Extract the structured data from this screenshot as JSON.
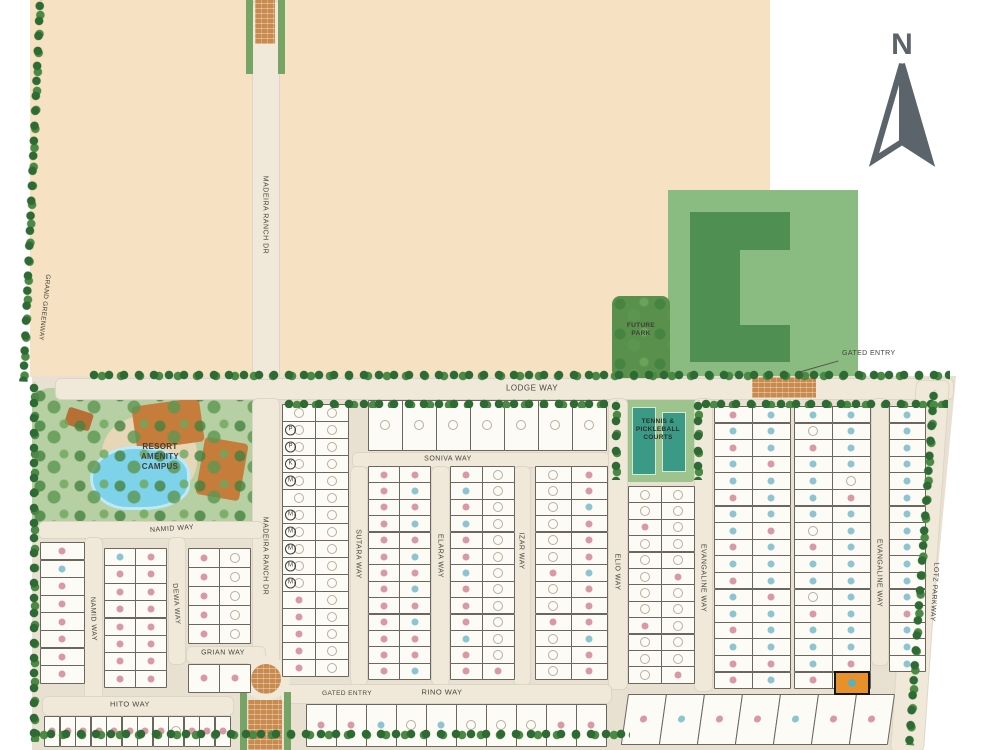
{
  "map": {
    "compass_label": "N",
    "labels": {
      "gated_entry_top": "GATED ENTRY",
      "gated_entry_bottom": "GATED ENTRY"
    },
    "areas": [
      {
        "id": "grand-greenway",
        "label": "GRAND GREENWAY"
      },
      {
        "id": "resort-amenity-campus",
        "label": "RESORT\nAMENITY\nCAMPUS"
      },
      {
        "id": "future-park",
        "label": "FUTURE\nPARK"
      },
      {
        "id": "tennis-pickleball-courts",
        "label": "TENNIS &\nPICKLEBALL\nCOURTS"
      },
      {
        "id": "future-site"
      }
    ],
    "colors": {
      "undeveloped": "#f6e2c2",
      "ground": "#e8e0d0",
      "road": "#f0e9da",
      "lot": "#fdfbf5",
      "greenway": "#5c8f4e",
      "park_light": "#8abc81",
      "park_dark": "#4f8f52",
      "court": "#3a9a85",
      "brick": "#c98a4e",
      "pool": "#7ed3ea",
      "building": "#c67c3b",
      "dot_pink": "#d998a5",
      "dot_blue": "#8ec4d2",
      "dot_open": "#b7af9f",
      "selected": "#e8912b"
    },
    "streets": [
      {
        "id": "lodge-way",
        "label": "LODGE WAY",
        "x": 55,
        "y": 378,
        "w": 897,
        "h": 20,
        "lx": 532,
        "ly": 388,
        "rot": 0,
        "fs": 8
      },
      {
        "id": "madeira-ranch-dr-north",
        "label": "MADEIRA RANCH DR",
        "x": 252,
        "y": 0,
        "w": 26,
        "h": 378,
        "lx": 265,
        "ly": 215,
        "rot": 90,
        "fs": 7
      },
      {
        "id": "madeira-ranch-dr-south",
        "label": "MADEIRA RANCH DR",
        "x": 252,
        "y": 398,
        "w": 26,
        "h": 288,
        "lx": 265,
        "ly": 556,
        "rot": 90,
        "fs": 7
      },
      {
        "id": "soniva-way",
        "label": "SONIVA WAY",
        "x": 352,
        "y": 452,
        "w": 256,
        "h": 14,
        "lx": 448,
        "ly": 459,
        "rot": 0,
        "fs": 7
      },
      {
        "id": "namid-way-h",
        "label": "NAMID WAY",
        "x": 38,
        "y": 521,
        "w": 224,
        "h": 16,
        "lx": 172,
        "ly": 529,
        "rot": -4,
        "fs": 7
      },
      {
        "id": "namid-way-v",
        "label": "NAMID WAY",
        "x": 84,
        "y": 537,
        "w": 17,
        "h": 192,
        "lx": 93,
        "ly": 619,
        "rot": 88,
        "fs": 7
      },
      {
        "id": "dewa-way",
        "label": "DEWA WAY",
        "x": 168,
        "y": 537,
        "w": 16,
        "h": 126,
        "lx": 176,
        "ly": 604,
        "rot": 86,
        "fs": 7
      },
      {
        "id": "grian-way",
        "label": "GRIAN WAY",
        "x": 186,
        "y": 646,
        "w": 78,
        "h": 16,
        "lx": 223,
        "ly": 653,
        "rot": 0,
        "fs": 7
      },
      {
        "id": "hito-way",
        "label": "HITO WAY",
        "x": 42,
        "y": 696,
        "w": 190,
        "h": 18,
        "lx": 130,
        "ly": 704,
        "rot": 0,
        "fs": 7.5
      },
      {
        "id": "sutara-way",
        "label": "SUTARA WAY",
        "x": 350,
        "y": 466,
        "w": 16,
        "h": 218,
        "lx": 358,
        "ly": 554,
        "rot": 90,
        "fs": 7
      },
      {
        "id": "elara-way",
        "label": "ELARA WAY",
        "x": 431,
        "y": 466,
        "w": 17,
        "h": 218,
        "lx": 440,
        "ly": 556,
        "rot": 90,
        "fs": 7
      },
      {
        "id": "izar-way",
        "label": "IZAR WAY",
        "x": 513,
        "y": 466,
        "w": 16,
        "h": 218,
        "lx": 521,
        "ly": 551,
        "rot": 90,
        "fs": 7
      },
      {
        "id": "elio-way",
        "label": "ELIO WAY",
        "x": 608,
        "y": 398,
        "w": 18,
        "h": 290,
        "lx": 617,
        "ly": 572,
        "rot": 90,
        "fs": 7
      },
      {
        "id": "evangaline-way",
        "label": "EVANGALINE WAY",
        "x": 694,
        "y": 398,
        "w": 17,
        "h": 292,
        "lx": 703,
        "ly": 578,
        "rot": 90,
        "fs": 7
      },
      {
        "id": "evangaline-way-2",
        "label": "EVANGALINE WAY",
        "x": 871,
        "y": 398,
        "w": 16,
        "h": 266,
        "lx": 879,
        "ly": 573,
        "rot": 90,
        "fs": 7
      },
      {
        "id": "lotz-parkway",
        "label": "LOTZ PARKWAY",
        "x": 916,
        "y": 380,
        "w": 32,
        "h": 370,
        "lx": 934,
        "ly": 592,
        "rot": 94,
        "fs": 7,
        "sk": -4
      },
      {
        "id": "rino-way",
        "label": "RINO WAY",
        "x": 280,
        "y": 684,
        "w": 330,
        "h": 18,
        "lx": 442,
        "ly": 692,
        "rot": 0,
        "fs": 7.5
      }
    ],
    "lot_blocks": [
      {
        "id": "a-madeira-sutara",
        "x": 282,
        "y": 404,
        "cols": 2,
        "rows": 16,
        "cw": 33,
        "ch": 17,
        "dots": [
          "oo",
          "oo",
          "oo",
          "oo",
          "oo",
          "oo",
          "oo",
          "oo",
          "oo",
          "oo",
          "oo",
          "po",
          "po",
          "po",
          "po",
          "po"
        ],
        "letters": [
          [
            1,
            0,
            "P"
          ],
          [
            2,
            0,
            "P"
          ],
          [
            3,
            0,
            "K"
          ],
          [
            4,
            0,
            "M"
          ],
          [
            6,
            0,
            "M"
          ],
          [
            7,
            0,
            "M"
          ],
          [
            8,
            0,
            "M"
          ],
          [
            9,
            0,
            "M"
          ],
          [
            10,
            0,
            "M"
          ]
        ]
      },
      {
        "id": "top-lodge-row",
        "x": 368,
        "y": 400,
        "cols": 7,
        "rows": 1,
        "cw": 34,
        "ch": 50,
        "dots": [
          "ooooooo"
        ]
      },
      {
        "id": "sutara-elara",
        "x": 368,
        "y": 466,
        "cols": 2,
        "rows": 13,
        "cw": 31,
        "ch": 16.4,
        "dots": [
          "pp",
          "pb",
          "pp",
          "pb",
          "pp",
          "pb",
          "pp",
          "pb",
          "pp",
          "pb",
          "pp",
          "pp",
          "pb"
        ]
      },
      {
        "id": "elara-izar",
        "x": 450,
        "y": 466,
        "cols": 2,
        "rows": 13,
        "cw": 32,
        "ch": 16.4,
        "dots": [
          "po",
          "bo",
          "po",
          "bo",
          "po",
          "po",
          "bo",
          "po",
          "po",
          "po",
          "bo",
          "po",
          "pp"
        ]
      },
      {
        "id": "izar-elio",
        "x": 535,
        "y": 466,
        "cols": 2,
        "rows": 13,
        "cw": 36,
        "ch": 16.4,
        "dots": [
          "op",
          "op",
          "ob",
          "op",
          "op",
          "op",
          "pb",
          "op",
          "op",
          "pp",
          "ob",
          "op",
          "op"
        ]
      },
      {
        "id": "elio-evangaline",
        "x": 628,
        "y": 486,
        "cols": 2,
        "rows": 12,
        "cw": 33,
        "ch": 16.4,
        "dots": [
          "oo",
          "oo",
          "po",
          "oo",
          "oo",
          "op",
          "oo",
          "oo",
          "po",
          "oo",
          "oo",
          "op"
        ]
      },
      {
        "id": "evangaline-a",
        "x": 714,
        "y": 406,
        "cols": 2,
        "rows": 17,
        "cw": 38,
        "ch": 16.6,
        "dots": [
          "pb",
          "bb",
          "pb",
          "bp",
          "bb",
          "pb",
          "bb",
          "bp",
          "pb",
          "bb",
          "pb",
          "bp",
          "bb",
          "pb",
          "bb",
          "pp",
          "pb"
        ]
      },
      {
        "id": "evangaline-b",
        "x": 794,
        "y": 406,
        "cols": 2,
        "rows": 17,
        "cw": 38,
        "ch": 16.6,
        "dots": [
          "bb",
          "ob",
          "pb",
          "bb",
          "bo",
          "bp",
          "bb",
          "ob",
          "pb",
          "bb",
          "bb",
          "ob",
          "pb",
          "bb",
          "bb",
          "bp",
          "pb"
        ]
      },
      {
        "id": "lotz-col",
        "x": 889,
        "y": 406,
        "cols": 1,
        "rows": 16,
        "cw": 36,
        "ch": 16.6,
        "dots": [
          "b",
          "b",
          "b",
          "b",
          "b",
          "b",
          "b",
          "b",
          "b",
          "b",
          "b",
          "b",
          "p",
          "b",
          "b",
          "b"
        ]
      },
      {
        "id": "west-edge-col",
        "x": 40,
        "y": 542,
        "cols": 1,
        "rows": 8,
        "cw": 44,
        "ch": 17.6,
        "dots": [
          "p",
          "b",
          "p",
          "p",
          "p",
          "p",
          "p",
          "p"
        ]
      },
      {
        "id": "namid-dewa",
        "x": 104,
        "y": 548,
        "cols": 2,
        "rows": 8,
        "cw": 31,
        "ch": 17.4,
        "dots": [
          "bp",
          "pp",
          "pp",
          "pp",
          "pp",
          "pp",
          "pp",
          "pp"
        ]
      },
      {
        "id": "dewa-madeira",
        "x": 188,
        "y": 548,
        "cols": 2,
        "rows": 5,
        "cw": 31,
        "ch": 19,
        "dots": [
          "po",
          "po",
          "po",
          "po",
          "po"
        ]
      },
      {
        "id": "grian-south",
        "x": 188,
        "y": 664,
        "cols": 2,
        "rows": 1,
        "cw": 31,
        "ch": 28,
        "dots": [
          "pp"
        ]
      },
      {
        "id": "hito-south",
        "x": 44,
        "y": 716,
        "cols": 12,
        "rows": 1,
        "cw": 15.5,
        "ch": 30,
        "dots": [
          "ppppppppoppp"
        ]
      },
      {
        "id": "rino-south",
        "x": 306,
        "y": 704,
        "cols": 10,
        "rows": 1,
        "cw": 30,
        "ch": 42,
        "dots": [
          "ppbobooopp"
        ]
      },
      {
        "id": "southeast-fan",
        "x": 628,
        "y": 694,
        "cols": 7,
        "rows": 1,
        "cw": 38,
        "ch": 50,
        "sk": -8,
        "dots": [
          "pbppbpp"
        ]
      }
    ],
    "selected_lot": {
      "x": 834,
      "y": 671,
      "w": 36,
      "h": 24,
      "dot": "blue"
    }
  }
}
